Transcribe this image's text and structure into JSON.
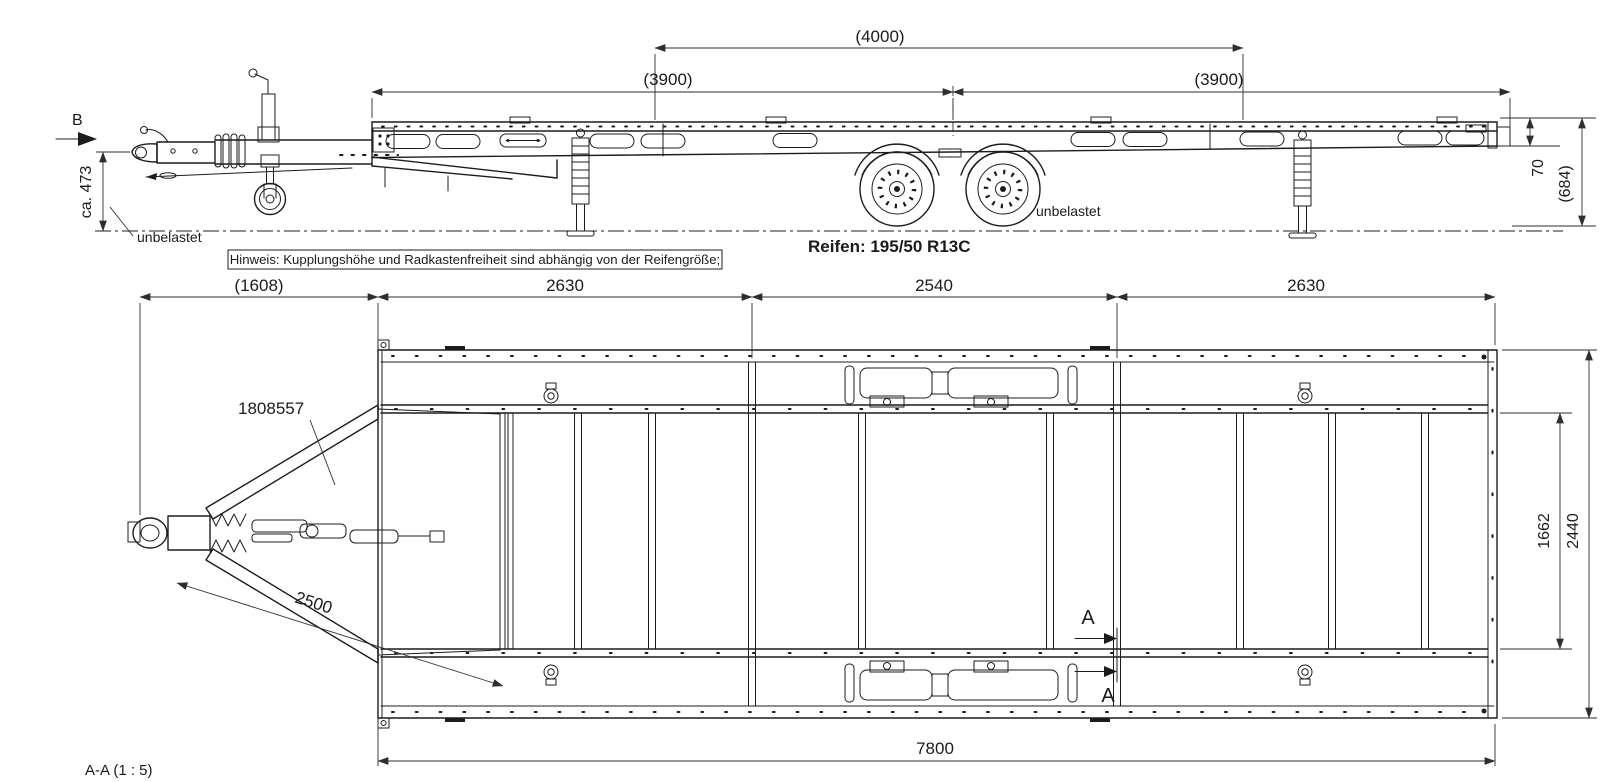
{
  "colors": {
    "line": "#1c1c1c",
    "background": "#ffffff"
  },
  "side_view": {
    "view_arrow_label": "B",
    "dim_4000": "(4000)",
    "dim_3900_left": "(3900)",
    "dim_3900_right": "(3900)",
    "dim_coupling_height": "ca. 473",
    "unloaded_front": "unbelastet",
    "unloaded_rear": "unbelastet",
    "dim_rear_frame_height": "70",
    "dim_rear_deck_height": "(684)",
    "note": "Hinweis: Kupplungshöhe und Radkastenfreiheit sind abhängig von der Reifengröße;",
    "tires": "Reifen: 195/50 R13C"
  },
  "top_view": {
    "dim_drawbar_length": "(1608)",
    "dim_segment_front": "2630",
    "dim_segment_middle": "2540",
    "dim_segment_rear": "2630",
    "drawbar_part_number": "1808557",
    "dim_drawbar_arm": "2500",
    "dim_inner_width": "1662",
    "dim_outer_width": "2440",
    "dim_total_length": "7800",
    "section_label_top": "A",
    "section_label_bottom": "A"
  },
  "footer": {
    "section_view_title": "A-A  (1 : 5)"
  }
}
